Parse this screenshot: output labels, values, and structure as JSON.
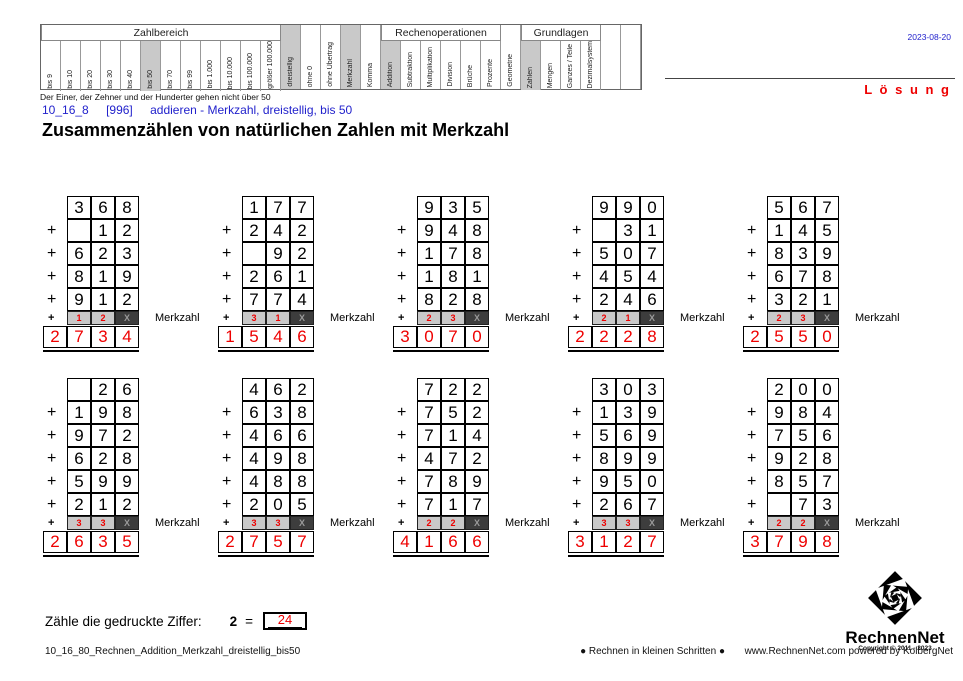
{
  "colors": {
    "red": "#ee0000",
    "blue": "#2222cc",
    "highlight": "#c9c9c9",
    "merk_dark": "#3d3d3d"
  },
  "header": {
    "date": "2023-08-20",
    "solution_label": "L ö s u n g",
    "caption": "Der Einer, der Zehner und der Hunderter gehen nicht über 50",
    "code": "10_16_8",
    "ref": "[996]",
    "subtitle": "addieren - Merkzahl, dreistellig, bis 50",
    "title": "Zusammenzählen von natürlichen Zahlen mit Merkzahl",
    "matrix": {
      "groups": [
        {
          "label": "Zahlbereich",
          "items": [
            {
              "label": "bis 9"
            },
            {
              "label": "bis 10"
            },
            {
              "label": "bis 20"
            },
            {
              "label": "bis 30"
            },
            {
              "label": "bis 40"
            },
            {
              "label": "bis 50",
              "selected": true
            },
            {
              "label": "bis 70"
            },
            {
              "label": "bis 99"
            },
            {
              "label": "bis 1.000"
            },
            {
              "label": "bis 10.000"
            },
            {
              "label": "bis 100.000"
            },
            {
              "label": "größer 100.000"
            }
          ]
        },
        {
          "label": null,
          "items": [
            {
              "label": "dreistellig",
              "selected": true
            },
            {
              "label": "ohne 0"
            },
            {
              "label": "ohne Übertrag"
            },
            {
              "label": "Merkzahl",
              "selected": true
            },
            {
              "label": "Komma"
            }
          ]
        },
        {
          "label": "Rechenoperationen",
          "items": [
            {
              "label": "Addition",
              "selected": true
            },
            {
              "label": "Subtraktion"
            },
            {
              "label": "Multiplikation"
            },
            {
              "label": "Division"
            },
            {
              "label": "Brüche"
            },
            {
              "label": "Prozente"
            }
          ]
        },
        {
          "label": null,
          "items": [
            {
              "label": "Geometrie"
            }
          ]
        },
        {
          "label": "Grundlagen",
          "items": [
            {
              "label": "Zahlen",
              "selected": true
            },
            {
              "label": "Mengen"
            },
            {
              "label": "Ganzes / Teile"
            },
            {
              "label": "Dezimalsystem"
            }
          ]
        },
        {
          "label": null,
          "items": [
            {
              "label": ""
            },
            {
              "label": ""
            }
          ]
        }
      ]
    }
  },
  "problems": {
    "plus_sign": "+",
    "merkzahl_label": "Merkzahl",
    "x_mark": "X",
    "items": [
      {
        "rows": [
          [
            "3",
            "6",
            "8"
          ],
          [
            "",
            "1",
            "2"
          ],
          [
            "6",
            "2",
            "3"
          ],
          [
            "8",
            "1",
            "9"
          ],
          [
            "9",
            "1",
            "2"
          ]
        ],
        "merk": [
          "1",
          "2"
        ],
        "result": [
          "2",
          "7",
          "3",
          "4"
        ]
      },
      {
        "rows": [
          [
            "1",
            "7",
            "7"
          ],
          [
            "2",
            "4",
            "2"
          ],
          [
            "",
            "9",
            "2"
          ],
          [
            "2",
            "6",
            "1"
          ],
          [
            "7",
            "7",
            "4"
          ]
        ],
        "merk": [
          "3",
          "1"
        ],
        "result": [
          "1",
          "5",
          "4",
          "6"
        ]
      },
      {
        "rows": [
          [
            "9",
            "3",
            "5"
          ],
          [
            "9",
            "4",
            "8"
          ],
          [
            "1",
            "7",
            "8"
          ],
          [
            "1",
            "8",
            "1"
          ],
          [
            "8",
            "2",
            "8"
          ]
        ],
        "merk": [
          "2",
          "3"
        ],
        "result": [
          "3",
          "0",
          "7",
          "0"
        ]
      },
      {
        "rows": [
          [
            "9",
            "9",
            "0"
          ],
          [
            "",
            "3",
            "1"
          ],
          [
            "5",
            "0",
            "7"
          ],
          [
            "4",
            "5",
            "4"
          ],
          [
            "2",
            "4",
            "6"
          ]
        ],
        "merk": [
          "2",
          "1"
        ],
        "result": [
          "2",
          "2",
          "2",
          "8"
        ]
      },
      {
        "rows": [
          [
            "5",
            "6",
            "7"
          ],
          [
            "1",
            "4",
            "5"
          ],
          [
            "8",
            "3",
            "9"
          ],
          [
            "6",
            "7",
            "8"
          ],
          [
            "3",
            "2",
            "1"
          ]
        ],
        "merk": [
          "2",
          "3"
        ],
        "result": [
          "2",
          "5",
          "5",
          "0"
        ]
      },
      {
        "rows": [
          [
            "",
            "2",
            "6"
          ],
          [
            "1",
            "9",
            "8"
          ],
          [
            "9",
            "7",
            "2"
          ],
          [
            "6",
            "2",
            "8"
          ],
          [
            "5",
            "9",
            "9"
          ],
          [
            "2",
            "1",
            "2"
          ]
        ],
        "merk": [
          "3",
          "3"
        ],
        "result": [
          "2",
          "6",
          "3",
          "5"
        ]
      },
      {
        "rows": [
          [
            "4",
            "6",
            "2"
          ],
          [
            "6",
            "3",
            "8"
          ],
          [
            "4",
            "6",
            "6"
          ],
          [
            "4",
            "9",
            "8"
          ],
          [
            "4",
            "8",
            "8"
          ],
          [
            "2",
            "0",
            "5"
          ]
        ],
        "merk": [
          "3",
          "3"
        ],
        "result": [
          "2",
          "7",
          "5",
          "7"
        ]
      },
      {
        "rows": [
          [
            "7",
            "2",
            "2"
          ],
          [
            "7",
            "5",
            "2"
          ],
          [
            "7",
            "1",
            "4"
          ],
          [
            "4",
            "7",
            "2"
          ],
          [
            "7",
            "8",
            "9"
          ],
          [
            "7",
            "1",
            "7"
          ]
        ],
        "merk": [
          "2",
          "2"
        ],
        "result": [
          "4",
          "1",
          "6",
          "6"
        ]
      },
      {
        "rows": [
          [
            "3",
            "0",
            "3"
          ],
          [
            "1",
            "3",
            "9"
          ],
          [
            "5",
            "6",
            "9"
          ],
          [
            "8",
            "9",
            "9"
          ],
          [
            "9",
            "5",
            "0"
          ],
          [
            "2",
            "6",
            "7"
          ]
        ],
        "merk": [
          "3",
          "3"
        ],
        "result": [
          "3",
          "1",
          "2",
          "7"
        ]
      },
      {
        "rows": [
          [
            "2",
            "0",
            "0"
          ],
          [
            "9",
            "8",
            "4"
          ],
          [
            "7",
            "5",
            "6"
          ],
          [
            "9",
            "2",
            "8"
          ],
          [
            "8",
            "5",
            "7"
          ],
          [
            "",
            "7",
            "3"
          ]
        ],
        "merk": [
          "2",
          "2"
        ],
        "result": [
          "3",
          "7",
          "9",
          "8"
        ]
      }
    ]
  },
  "task": {
    "text": "Zähle die gedruckte Ziffer:",
    "digit": "2",
    "equals": "=",
    "count": "24"
  },
  "footer": {
    "filename": "10_16_80_Rechnen_Addition_Merkzahl_dreistellig_bis50",
    "slogan": "● Rechnen in kleinen Schritten ●",
    "site": "www.RechnenNet.com powered by KolbergNet",
    "logo_name": "RechnenNet",
    "copyright": "Copyright © 2011 - 2023"
  }
}
